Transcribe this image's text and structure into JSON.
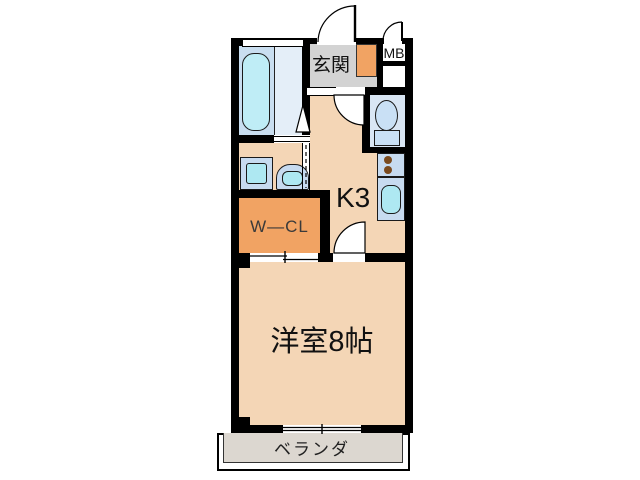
{
  "plan": {
    "title": "1K apartment floor plan",
    "rooms": {
      "entrance": {
        "label": "玄関"
      },
      "meter_box": {
        "label": "MB"
      },
      "kitchen": {
        "label": "K3"
      },
      "walk_in_closet": {
        "label": "W—CL"
      },
      "main_room": {
        "label": "洋室8帖"
      },
      "veranda": {
        "label": "ベランダ"
      }
    },
    "fixtures": [
      "bathtub",
      "bathroom-window",
      "washing-machine-pan",
      "vanity-sink",
      "shoe-cabinet",
      "toilet",
      "stove-burners",
      "kitchen-sink"
    ],
    "colors": {
      "wall": "#000000",
      "floor_peach": "#F4D6B6",
      "closet_orange": "#F1A363",
      "entrance_gray": "#D3D3D3",
      "veranda_gray": "#DCD7D0",
      "wet_area_blue": "#C9DEF0",
      "bath_floor_light": "#E4EEF8",
      "toilet_floor": "#D9E6F4",
      "counter_blue": "#C7DBF0",
      "basin_cyan": "#AEE8F2",
      "tub_cyan": "#BFEDF6",
      "burner_brown": "#7A4A1E"
    }
  }
}
